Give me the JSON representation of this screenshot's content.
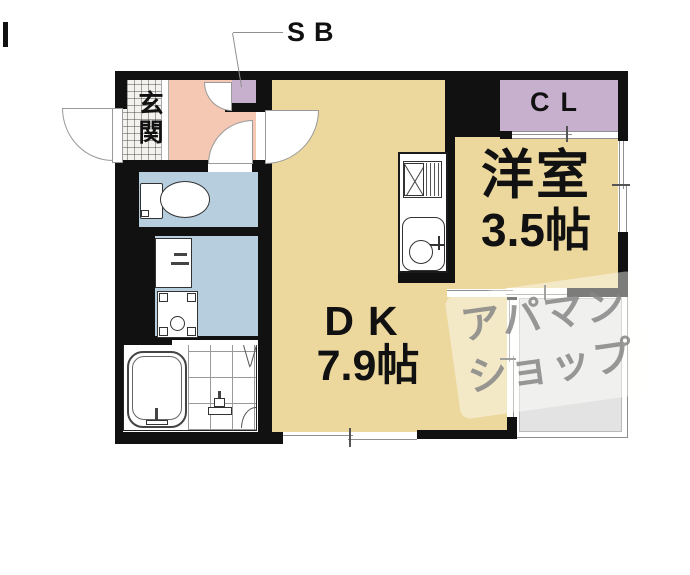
{
  "floorplan": {
    "callout": {
      "label": "SB"
    },
    "rooms": {
      "entrance": {
        "label": "玄関"
      },
      "closet": {
        "label": "CL"
      },
      "western": {
        "name": "洋室",
        "size": "3.5帖"
      },
      "dining_kitchen": {
        "name": "DK",
        "size": "7.9帖"
      }
    },
    "watermark": {
      "line1": "アパマン",
      "line2": "ショップ"
    },
    "colors": {
      "room_tan": "#ecd79d",
      "hall_pink": "#f4c8b2",
      "wet_area_blue": "#b7cedf",
      "closet_purple": "#c6b0ce",
      "balcony_gray": "#e3e3e3",
      "wall_black": "#111111",
      "watermark_gray": "#8e8e8e"
    }
  }
}
